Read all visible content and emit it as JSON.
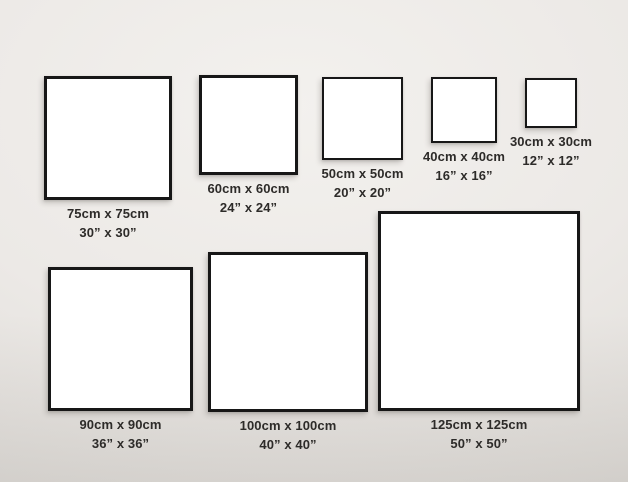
{
  "frames": [
    {
      "id": "75x75",
      "cm": 75,
      "inches": 30,
      "label_cm": "75cm x 75cm",
      "label_in": "30” x 30”"
    },
    {
      "id": "60x60",
      "cm": 60,
      "inches": 24,
      "label_cm": "60cm x 60cm",
      "label_in": "24” x 24”"
    },
    {
      "id": "50x50",
      "cm": 50,
      "inches": 20,
      "label_cm": "50cm x 50cm",
      "label_in": "20” x 20”"
    },
    {
      "id": "40x40",
      "cm": 40,
      "inches": 16,
      "label_cm": "40cm x 40cm",
      "label_in": "16” x 16”"
    },
    {
      "id": "30x30",
      "cm": 30,
      "inches": 12,
      "label_cm": "30cm x 30cm",
      "label_in": "12” x 12”"
    },
    {
      "id": "90x90",
      "cm": 90,
      "inches": 36,
      "label_cm": "90cm x 90cm",
      "label_in": "36” x 36”"
    },
    {
      "id": "100x100",
      "cm": 100,
      "inches": 40,
      "label_cm": "100cm x 100cm",
      "label_in": "40” x 40”"
    },
    {
      "id": "125x125",
      "cm": 125,
      "inches": 50,
      "label_cm": "125cm x 125cm",
      "label_in": "50” x 50”"
    }
  ]
}
